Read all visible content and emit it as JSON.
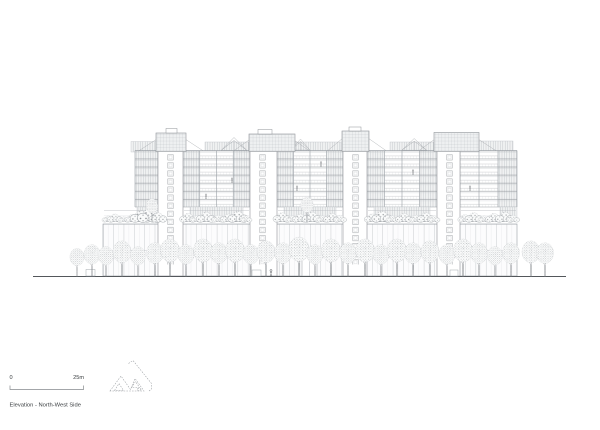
{
  "sheet": {
    "background": "#ffffff",
    "caption": "Elevation - North-West Side",
    "scale_bar": {
      "start_label": "0",
      "end_label": "25m"
    },
    "palette": {
      "line": "#9aa0a6",
      "line_light": "#c6cacd",
      "line_dark": "#53575b",
      "text": "#3c4043",
      "panel_fill": "#eef0f1"
    },
    "drawing": {
      "type": "architectural-elevation",
      "subject": "Multi-storey residential block: four service cores with rooftop plant boxes and pergola trusses, seven balcony floors, podium roof gardens, glazed podium and street trees on a ground line",
      "cores": 4,
      "balcony_floors": 7,
      "street_trees": 30
    }
  }
}
